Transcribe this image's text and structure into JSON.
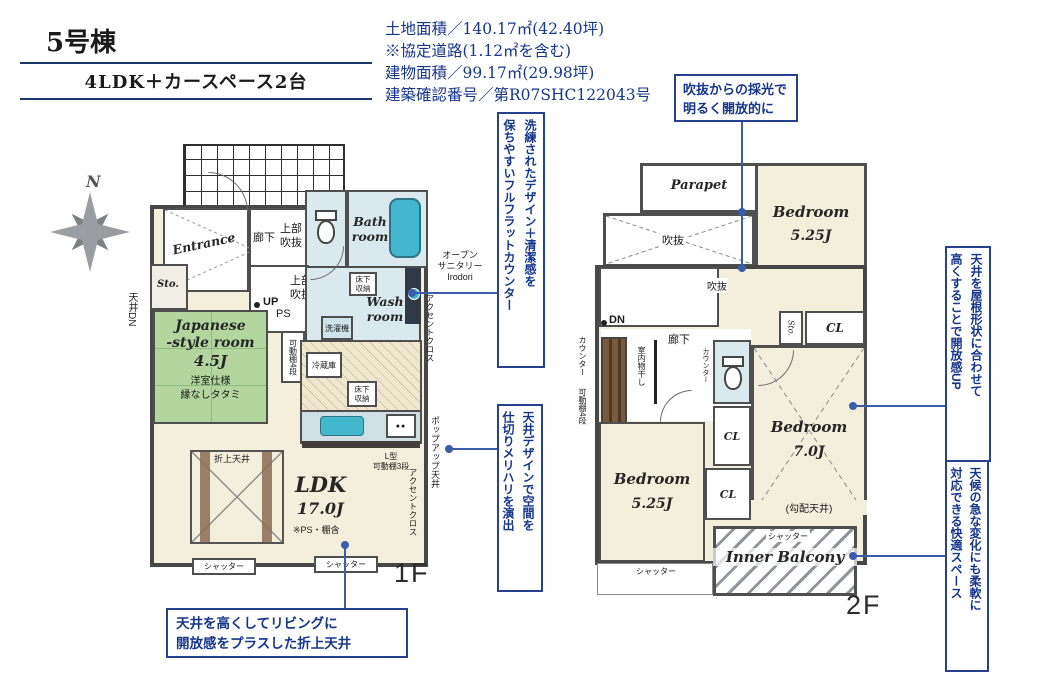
{
  "header": {
    "building": "5号棟",
    "plan": "4LDK＋カースペース2台"
  },
  "site_info": {
    "lines": [
      "土地面積／140.17㎡(42.40坪)",
      "※協定道路(1.12㎡を含む)",
      "建物面積／99.17㎡(29.98坪)",
      "建築確認番号／第R07SHC122043号"
    ]
  },
  "compass": {
    "north": "N"
  },
  "callouts": {
    "atrium": "吹抜からの採光で\n明るく開放的に",
    "flat_counter": "洗練されたデザイン＋清潔感を\n保ちやすいフルフラットカウンター",
    "ceiling_zone": "天井デザインで空間を\n仕切りメリハリを演出",
    "coffered": "天井を高くしてリビングに\n開放感をプラスした折上天井",
    "sloped_ceiling": "天井を屋根形状に合わせて\n高くすることで開放感UP",
    "inner_balcony": "天候の急な変化にも柔軟に\n対応できる快適スペース"
  },
  "labels": {
    "shutter": "シャッター",
    "floor_storage": "床下\n収納",
    "upper_void": "上部\n吹抜",
    "void": "吹抜",
    "cl": "CL",
    "counter": "カウンター",
    "shelf4": "可動棚4段",
    "accent_cloth": "アクセントクロス",
    "hall": "廊下",
    "storage": "Sto."
  },
  "floor1": {
    "label": "1F",
    "entrance": "Entrance",
    "bath": "Bath\nroom",
    "wash": "Wash\nroom",
    "up": "UP",
    "ps": "PS",
    "ceiling_dn": "天井DN",
    "washer": "洗濯機",
    "open_sanitary": "オープン\nサニタリー\nIrodori",
    "japanese_room": {
      "name": "Japanese\n-style room",
      "size": "4.5J",
      "note1": "洋室仕様",
      "note2": "縁なしタタミ"
    },
    "fridge": "冷蔵庫",
    "popup_ceiling": "ポップアップ天井",
    "l_shelf": "L型\n可動棚3段",
    "coffered": "折上天井",
    "ldk": {
      "name": "LDK",
      "size": "17.0J",
      "note": "※PS・棚含"
    }
  },
  "floor2": {
    "label": "2F",
    "parapet": "Parapet",
    "dn": "DN",
    "drying": "室内物干し",
    "bedroom1": {
      "name": "Bedroom",
      "size": "5.25J"
    },
    "bedroom2": {
      "name": "Bedroom",
      "size": "7.0J"
    },
    "bedroom3": {
      "name": "Bedroom",
      "size": "5.25J"
    },
    "sloped_note": "(勾配天井)",
    "inner_balcony": "Inner Balcony"
  },
  "colors": {
    "navy": "#16368c",
    "leader": "#3b5ca8",
    "wall": "#4a4a4a",
    "tatami": "#b2d69e",
    "water": "#d9e9ed",
    "fixture": "#43b7cd",
    "cream": "#f4eedd"
  }
}
